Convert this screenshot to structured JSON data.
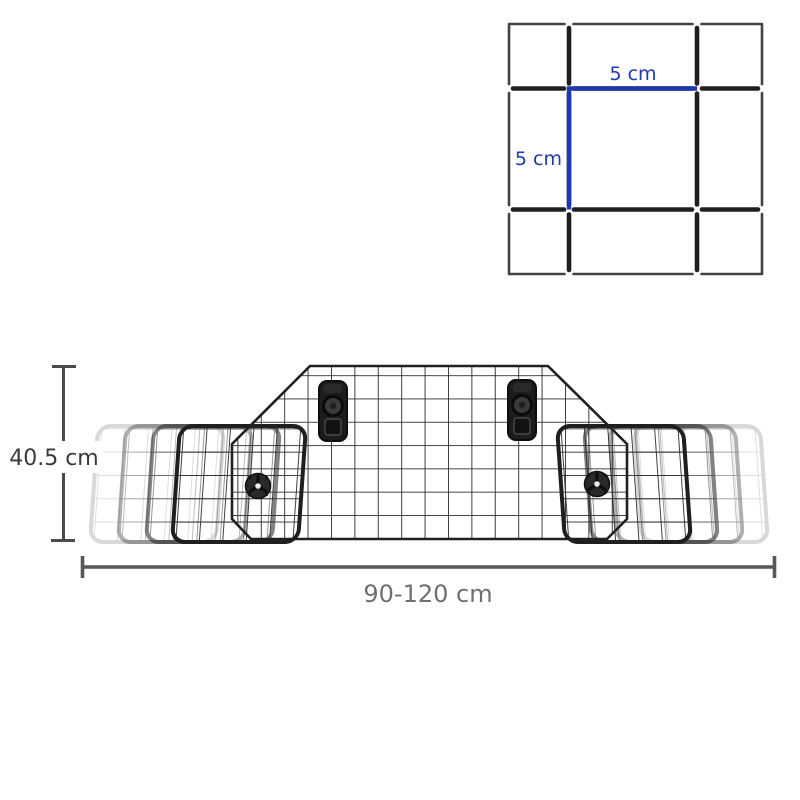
{
  "inset": {
    "width_label": "5 cm",
    "height_label": "5 cm"
  },
  "dimensions": {
    "height_label": "40.5 cm",
    "width_label": "90-120 cm"
  },
  "colors": {
    "background": "#ffffff",
    "accent_blue": "#1c3aad",
    "wire_dark": "#202023",
    "wire_grid": "#2b2b2d",
    "inset_border": "#434347",
    "panel_border": "#1f1f1f",
    "dim_line_dark": "#4a4a4a",
    "dim_line_gray": "#57575a",
    "dim_text_dark": "#3a3a3a",
    "dim_text_gray": "#6f6f6f",
    "hardware_black": "#1c1c1e"
  }
}
